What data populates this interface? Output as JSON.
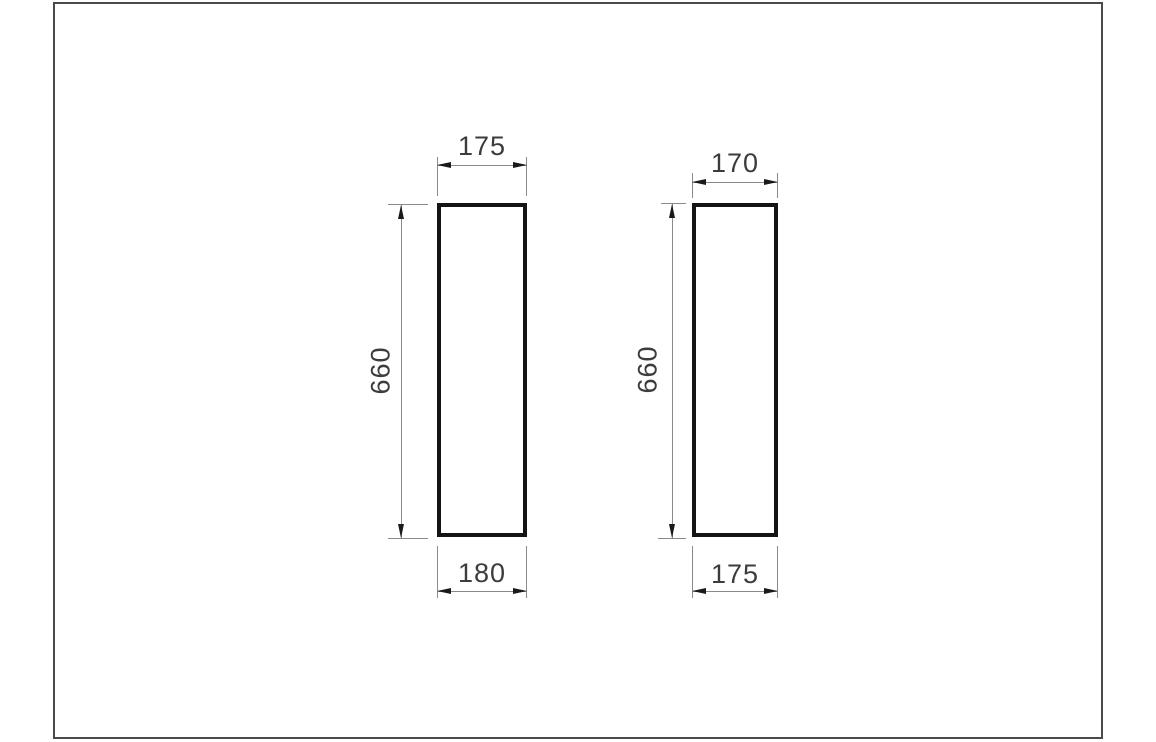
{
  "drawing": {
    "left_panel": {
      "top_width": "175",
      "height": "660",
      "bottom_width": "180"
    },
    "right_panel": {
      "top_width": "170",
      "height": "660",
      "bottom_width": "175"
    }
  },
  "colors": {
    "background": "#ffffff",
    "frame": "#4a4a4a",
    "outline": "#141414",
    "dimension_line": "#8a8a8a",
    "arrow": "#1a1a1a",
    "text": "#3c3c3c"
  }
}
